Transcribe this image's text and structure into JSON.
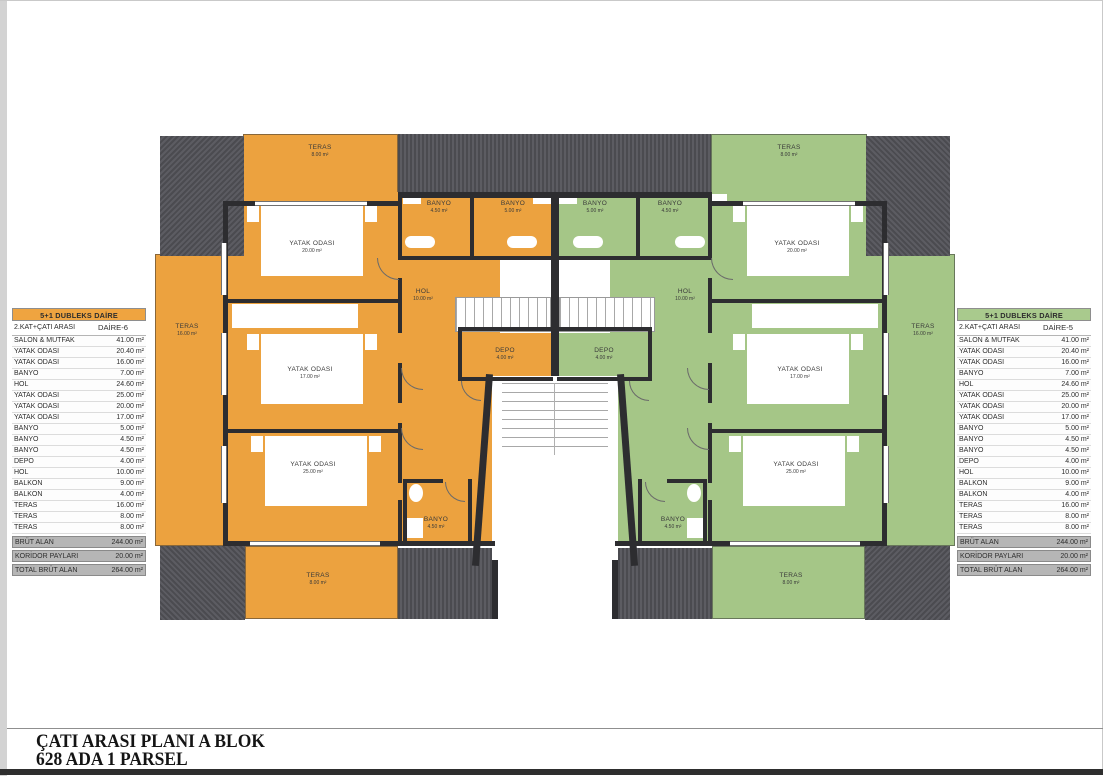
{
  "page": {
    "title_line1": "ÇATI ARASI PLANI A BLOK",
    "title_line2": "628 ADA 1 PARSEL"
  },
  "tables": {
    "left": {
      "header": "5+1 DUBLEKS DAİRE",
      "subheader": "2.KAT+ÇATI ARASI",
      "unit": "DAİRE-6",
      "accent": "#EFA440",
      "rows": [
        [
          "SALON & MUTFAK",
          "41.00 m²"
        ],
        [
          "YATAK ODASI",
          "20.40 m²"
        ],
        [
          "YATAK ODASI",
          "16.00 m²"
        ],
        [
          "BANYO",
          "7.00 m²"
        ],
        [
          "HOL",
          "24.60 m²"
        ],
        [
          "YATAK ODASI",
          "25.00 m²"
        ],
        [
          "YATAK ODASI",
          "20.00 m²"
        ],
        [
          "YATAK ODASI",
          "17.00 m²"
        ],
        [
          "BANYO",
          "5.00 m²"
        ],
        [
          "BANYO",
          "4.50 m²"
        ],
        [
          "BANYO",
          "4.50 m²"
        ],
        [
          "DEPO",
          "4.00 m²"
        ],
        [
          "HOL",
          "10.00 m²"
        ],
        [
          "BALKON",
          "9.00 m²"
        ],
        [
          "BALKON",
          "4.00 m²"
        ],
        [
          "TERAS",
          "16.00 m²"
        ],
        [
          "TERAS",
          "8.00 m²"
        ],
        [
          "TERAS",
          "8.00 m²"
        ]
      ],
      "summary": [
        [
          "BRÜT ALAN",
          "244.00 m²"
        ],
        [
          "KORİDOR PAYLARI",
          "20.00 m²"
        ],
        [
          "TOTAL BRÜT ALAN",
          "264.00 m²"
        ]
      ]
    },
    "right": {
      "header": "5+1 DUBLEKS DAİRE",
      "subheader": "2.KAT+ÇATI ARASI",
      "unit": "DAİRE-5",
      "accent": "#A9CA8D",
      "rows": [
        [
          "SALON & MUTFAK",
          "41.00 m²"
        ],
        [
          "YATAK ODASI",
          "20.40 m²"
        ],
        [
          "YATAK ODASI",
          "16.00 m²"
        ],
        [
          "BANYO",
          "7.00 m²"
        ],
        [
          "HOL",
          "24.60 m²"
        ],
        [
          "YATAK ODASI",
          "25.00 m²"
        ],
        [
          "YATAK ODASI",
          "20.00 m²"
        ],
        [
          "YATAK ODASI",
          "17.00 m²"
        ],
        [
          "BANYO",
          "5.00 m²"
        ],
        [
          "BANYO",
          "4.50 m²"
        ],
        [
          "BANYO",
          "4.50 m²"
        ],
        [
          "DEPO",
          "4.00 m²"
        ],
        [
          "HOL",
          "10.00 m²"
        ],
        [
          "BALKON",
          "9.00 m²"
        ],
        [
          "BALKON",
          "4.00 m²"
        ],
        [
          "TERAS",
          "16.00 m²"
        ],
        [
          "TERAS",
          "8.00 m²"
        ],
        [
          "TERAS",
          "8.00 m²"
        ]
      ],
      "summary": [
        [
          "BRÜT ALAN",
          "244.00 m²"
        ],
        [
          "KORİDOR PAYLARI",
          "20.00 m²"
        ],
        [
          "TOTAL BRÜT ALAN",
          "264.00 m²"
        ]
      ]
    }
  },
  "plan": {
    "colors": {
      "unit_left": "#ECA23F",
      "unit_right": "#A5C687",
      "roof": "#54545A",
      "wall": "#2D2D30"
    },
    "rooms": {
      "teras_top_o": {
        "name": "TERAS",
        "area": "8.00 m²"
      },
      "teras_left_o": {
        "name": "TERAS",
        "area": "16.00 m²"
      },
      "teras_bottom_o": {
        "name": "TERAS",
        "area": "8.00 m²"
      },
      "bed1_o": {
        "name": "YATAK ODASI",
        "area": "20.00 m²"
      },
      "bed2_o": {
        "name": "YATAK ODASI",
        "area": "17.00 m²"
      },
      "bed3_o": {
        "name": "YATAK ODASI",
        "area": "25.00 m²"
      },
      "banyo1_o": {
        "name": "BANYO",
        "area": "4.50 m²"
      },
      "banyo2_o": {
        "name": "BANYO",
        "area": "5.00 m²"
      },
      "banyo3_o": {
        "name": "BANYO",
        "area": "4.50 m²"
      },
      "hol_o": {
        "name": "HOL",
        "area": "10.00 m²"
      },
      "depo_o": {
        "name": "DEPO",
        "area": "4.00 m²"
      },
      "teras_top_g": {
        "name": "TERAS",
        "area": "8.00 m²"
      },
      "teras_right_g": {
        "name": "TERAS",
        "area": "16.00 m²"
      },
      "teras_bottom_g": {
        "name": "TERAS",
        "area": "8.00 m²"
      },
      "bed1_g": {
        "name": "YATAK ODASI",
        "area": "20.00 m²"
      },
      "bed2_g": {
        "name": "YATAK ODASI",
        "area": "17.00 m²"
      },
      "bed3_g": {
        "name": "YATAK ODASI",
        "area": "25.00 m²"
      },
      "banyo1_g": {
        "name": "BANYO",
        "area": "5.00 m²"
      },
      "banyo2_g": {
        "name": "BANYO",
        "area": "4.50 m²"
      },
      "banyo3_g": {
        "name": "BANYO",
        "area": "4.50 m²"
      },
      "hol_g": {
        "name": "HOL",
        "area": "10.00 m²"
      },
      "depo_g": {
        "name": "DEPO",
        "area": "4.00 m²"
      }
    }
  }
}
